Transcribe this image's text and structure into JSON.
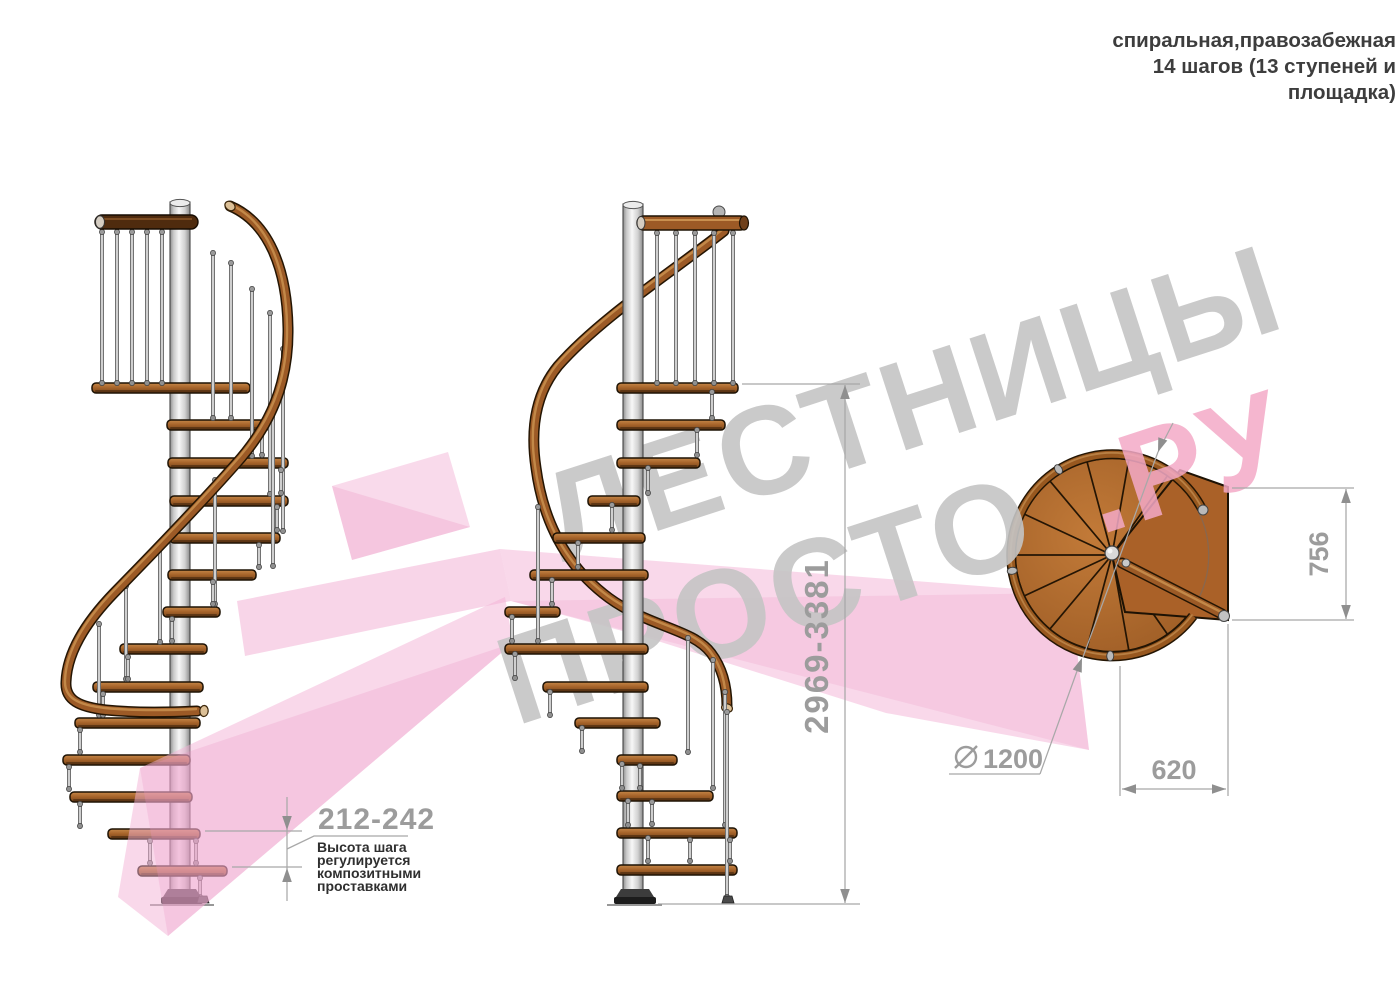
{
  "title_lines": [
    "спиральная,правозабежная",
    "14 шагов (13 ступеней и",
    "площадка)"
  ],
  "watermark": {
    "word1": "ЛЕСТНИЦЫ",
    "word2": "ПРОСТО",
    "word2_suffix": ".РУ",
    "gray_color": "#c4c4c4",
    "pink_color": "#f3a9c7",
    "ribbon_color": "#f3b2d6"
  },
  "dimensions": {
    "total_height": "2969-3381",
    "step_height": "212-242",
    "step_height_note": [
      "Высота шага",
      "регулируется",
      "композитными",
      "проставками"
    ],
    "landing_depth": "756",
    "going_width": "620",
    "diameter": "1200"
  },
  "colors": {
    "wood": "#a8652b",
    "handrail": "#9c5a26",
    "rail_outline": "#241503",
    "pole": "#d9d9d9",
    "dimension": "#9c9c9c",
    "note_text": "#2f2f2f",
    "title_text": "#3d3d3d"
  }
}
